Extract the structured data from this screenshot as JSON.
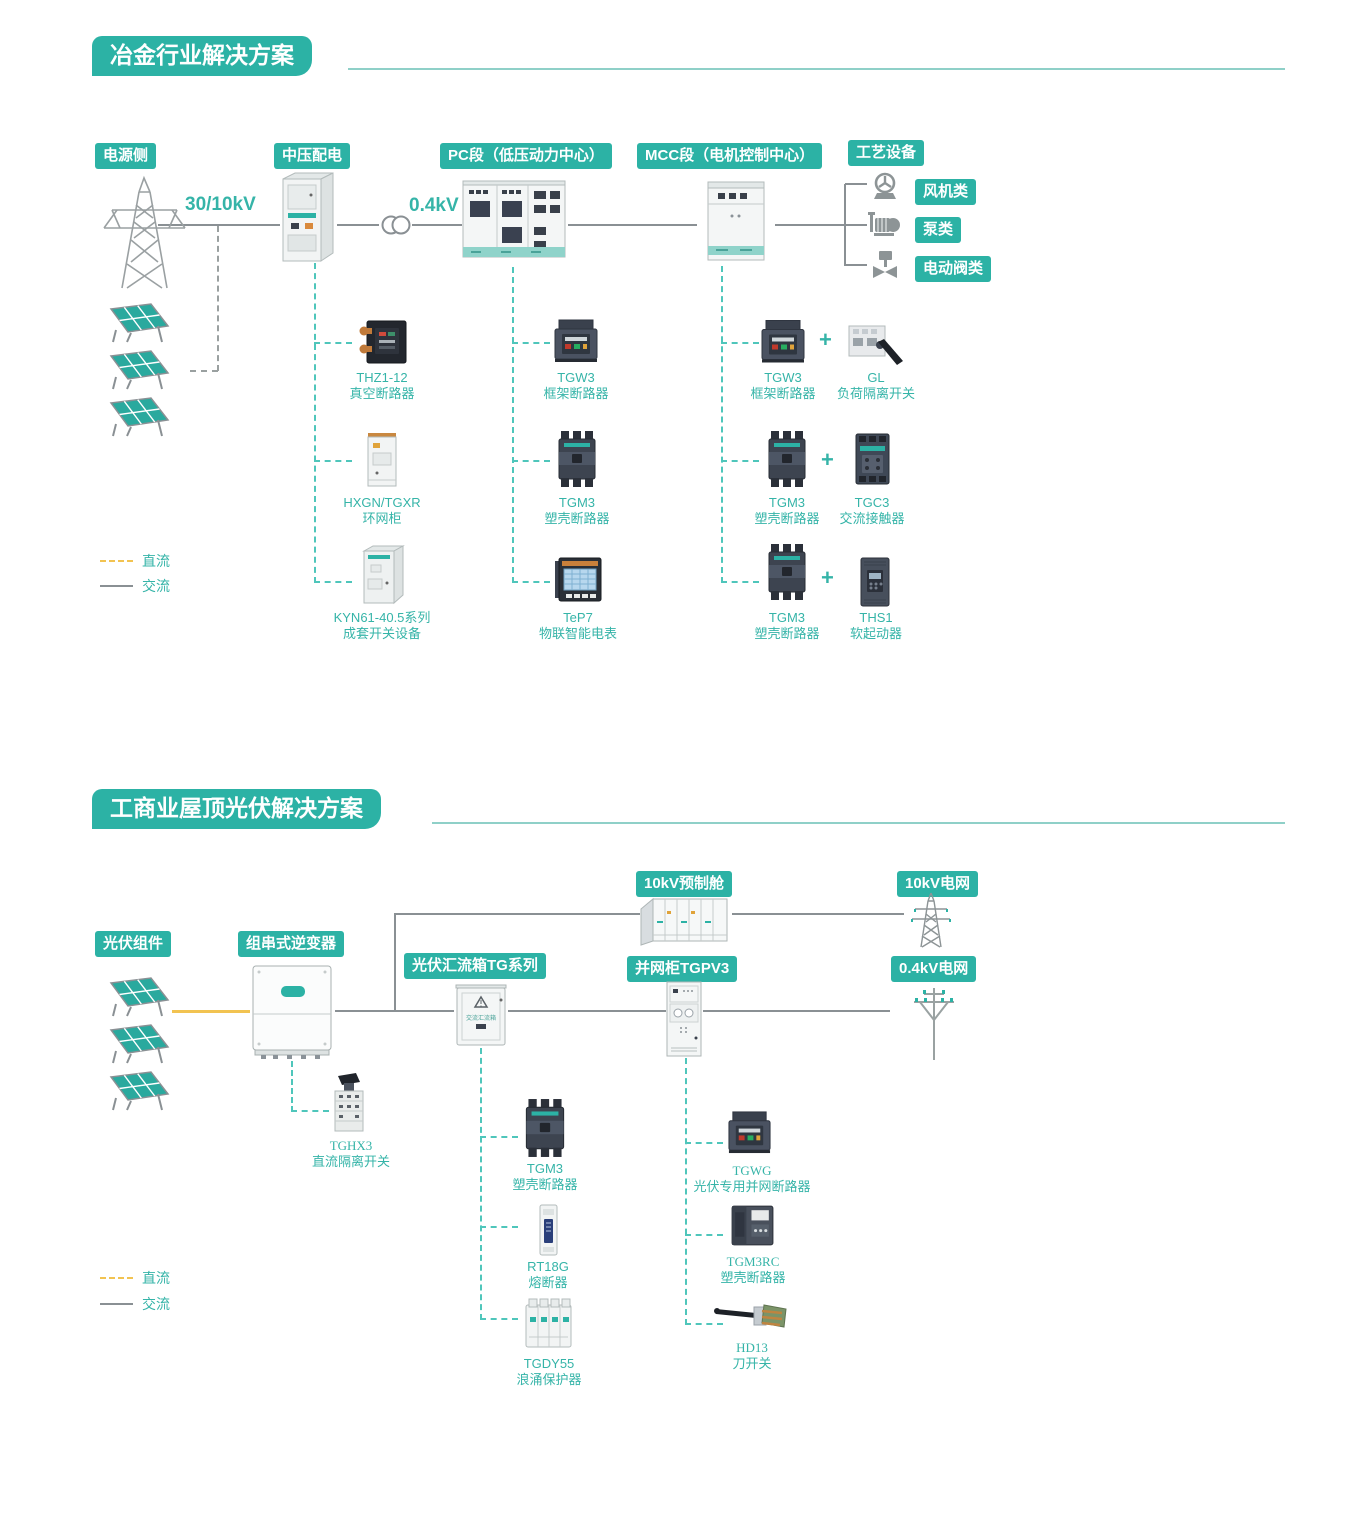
{
  "colors": {
    "accent_teal": "#2cb2a5",
    "line_gray": "#8a9094",
    "dc_yellow": "#f2c351",
    "dash_teal": "#4fc6bb"
  },
  "s1": {
    "title": "冶金行业解决方案",
    "badges": {
      "power_side": "电源侧",
      "mv_distribution": "中压配电",
      "pc_section": "PC段（低压动力中心）",
      "mcc_section": "MCC段（电机控制中心）",
      "process_equipment": "工艺设备",
      "fan": "风机类",
      "pump": "泵类",
      "valve": "电动阀类"
    },
    "voltages": {
      "hv": "30/10kV",
      "lv": "0.4kV"
    },
    "mv_products": [
      {
        "model": "THZ1-12",
        "desc": "真空断路器"
      },
      {
        "model": "HXGN/TGXR",
        "desc": "环网柜"
      },
      {
        "model": "KYN61-40.5系列",
        "desc": "成套开关设备"
      }
    ],
    "pc_products": [
      {
        "model": "TGW3",
        "desc": "框架断路器"
      },
      {
        "model": "TGM3",
        "desc": "塑壳断路器"
      },
      {
        "model": "TeP7",
        "desc": "物联智能电表"
      }
    ],
    "mcc_products": [
      {
        "model": "TGW3",
        "desc": "框架断路器",
        "plus": "+",
        "model2": "GL",
        "desc2": "负荷隔离开关"
      },
      {
        "model": "TGM3",
        "desc": "塑壳断路器",
        "plus": "+",
        "model2": "TGC3",
        "desc2": "交流接触器"
      },
      {
        "model": "TGM3",
        "desc": "塑壳断路器",
        "plus": "+",
        "model2": "THS1",
        "desc2": "软起动器"
      }
    ],
    "legend": {
      "dc": "直流",
      "ac": "交流"
    }
  },
  "s2": {
    "title": "工商业屋顶光伏解决方案",
    "badges": {
      "pv_modules": "光伏组件",
      "string_inverter": "组串式逆变器",
      "combiner_box": "光伏汇流箱TG系列",
      "prefab_cabin": "10kV预制舱",
      "grid_10kv": "10kV电网",
      "grid_cabinet": "并网柜TGPV3",
      "grid_04kv": "0.4kV电网"
    },
    "combiner_face_text": "交流汇流箱",
    "inverter_product": {
      "model": "TGHX3",
      "desc": "直流隔离开关"
    },
    "combiner_products": [
      {
        "model": "TGM3",
        "desc": "塑壳断路器"
      },
      {
        "model": "RT18G",
        "desc": "熔断器"
      },
      {
        "model": "TGDY55",
        "desc": "浪涌保护器"
      }
    ],
    "grid_products": [
      {
        "model": "TGWG",
        "desc": "光伏专用并网断路器"
      },
      {
        "model": "TGM3RC",
        "desc": "塑壳断路器"
      },
      {
        "model": "HD13",
        "desc": "刀开关"
      }
    ],
    "legend": {
      "dc": "直流",
      "ac": "交流"
    }
  }
}
